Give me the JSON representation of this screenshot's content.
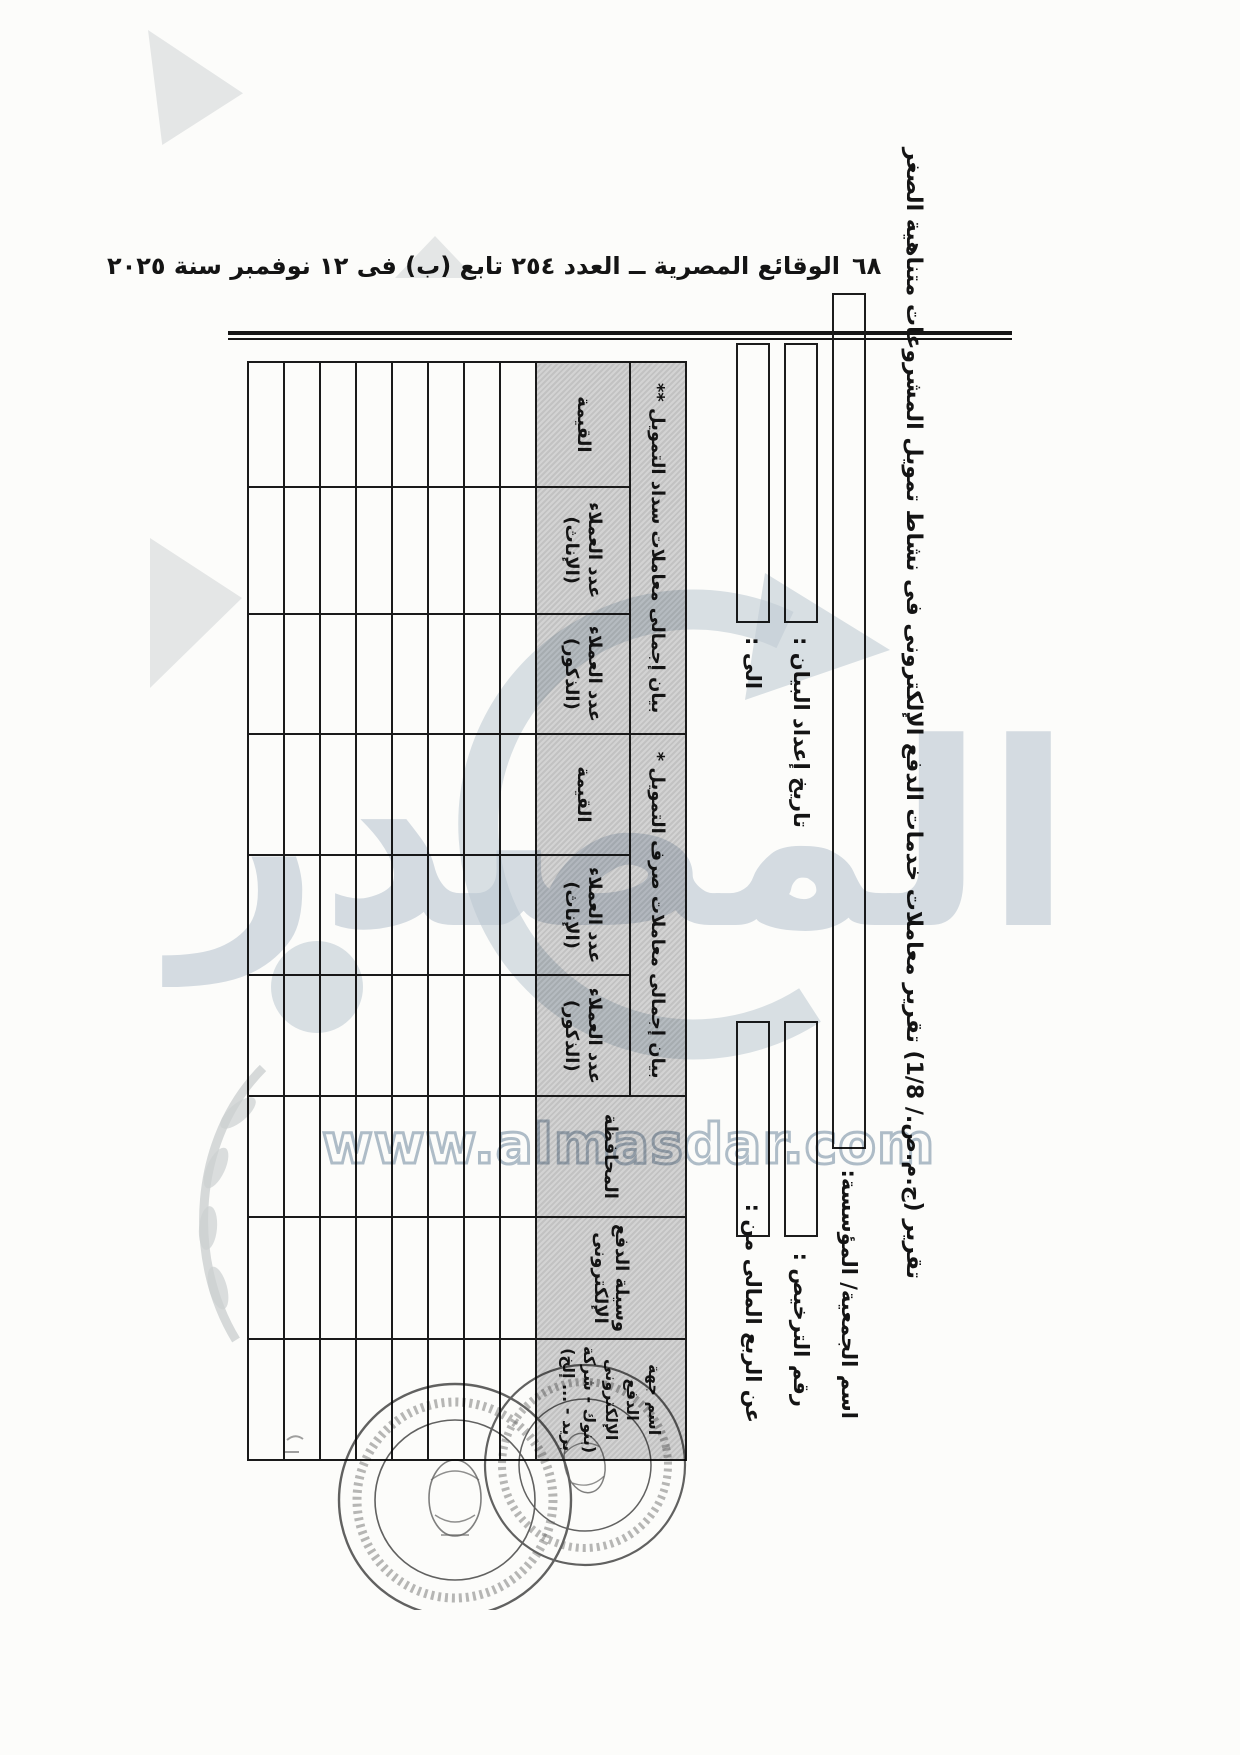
{
  "page": {
    "number": "٦٨",
    "running_header": "الوقائع المصرية ــ العدد ٢٥٤ تابع (ب) فى ١٢ نوفمبر سنة ٢٠٢٥"
  },
  "form": {
    "title": "تقرير (ج.م.ص./ 1/8) تقرير معاملات خدمات الدفع الإلكترونى فى نشاط تمويل المشروعات متناهية الصغر",
    "fields": {
      "org_name": "اسم الجمعية/ المؤسسة:",
      "license_no": "رقم الترخيص :",
      "report_date": "تاريخ إعداد البيان :",
      "quarter_from": "عن الربع المالى من :",
      "quarter_to": "الى :"
    },
    "table": {
      "provider": "اسم جهة الدفع الإلكترونى (بنوك - شركة بريد - ... إلخ)",
      "method": "وسيلة الدفع الإلكترونى",
      "governorate": "المحافظة",
      "group_disburse": "بيان إجمالى معاملات صرف التمويل *",
      "group_repay": "بيان إجمالى معاملات سداد التمويل **",
      "sub_males": "عدد العملاء (الذكور)",
      "sub_females": "عدد العملاء (الإناث)",
      "sub_value": "القيمة",
      "data_rows": 8,
      "columns": 9
    }
  },
  "watermark": {
    "logo": "المصدر",
    "url": "www.almasdar.com",
    "color": "#b9c5d2"
  }
}
